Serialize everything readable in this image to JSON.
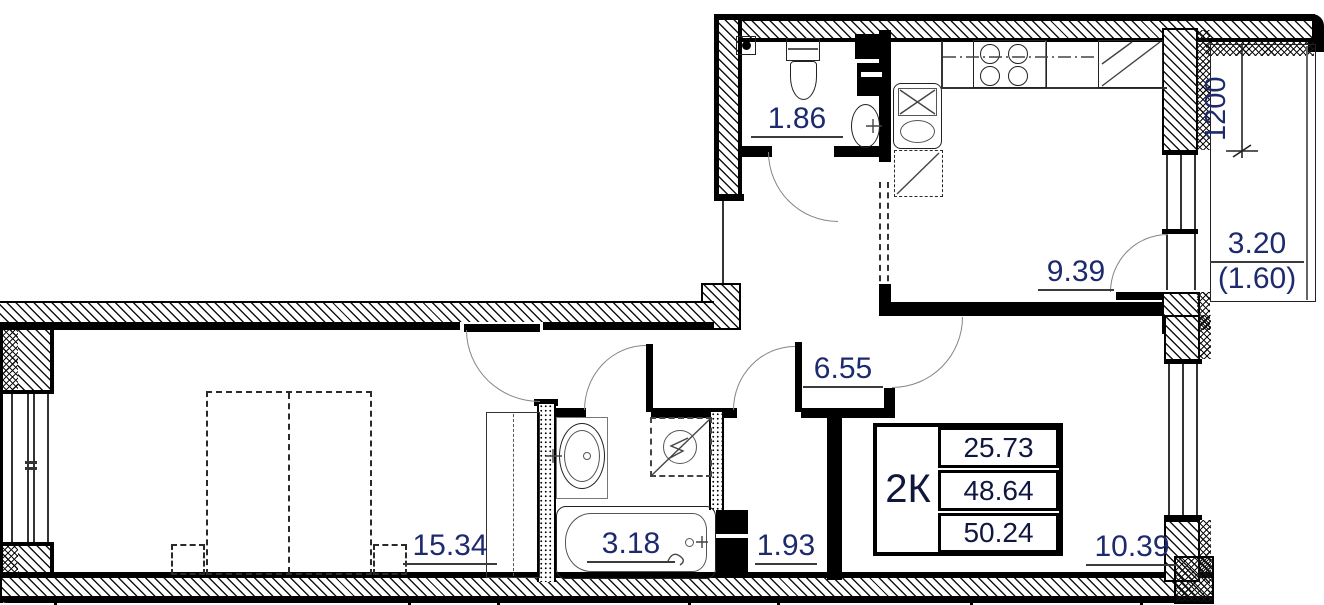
{
  "drawing": {
    "type_note": "apartment floor plan, 2-room flat",
    "labels": {
      "wc": "1.86",
      "kitchen": "9.39",
      "balcony_full": "3.20",
      "balcony_reduced": "(1.60)",
      "balcony_width": "1200",
      "corridor": "6.55",
      "bedroom": "15.34",
      "bathroom": "3.18",
      "storage": "1.93",
      "living": "10.39"
    },
    "summary_table": {
      "type": "2К",
      "rows": [
        "25.73",
        "48.64",
        "50.24"
      ]
    },
    "colors": {
      "wall": "#000000",
      "label_text": "#1d2a6e"
    }
  }
}
